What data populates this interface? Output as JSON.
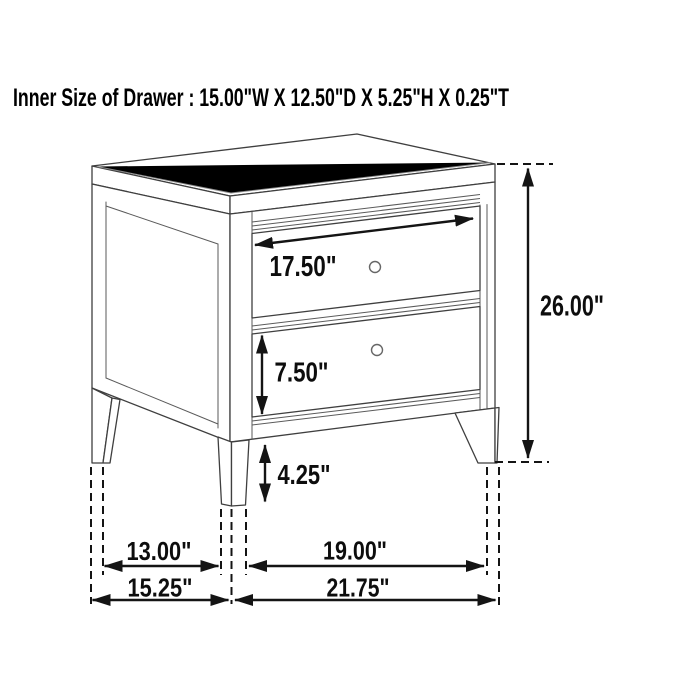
{
  "title": "Inner Size of Drawer : 15.00\"W X 12.50\"D X 5.25\"H X 0.25\"T",
  "dimension_labels": {
    "top_drawer_width": "17.50\"",
    "overall_height": "26.00\"",
    "bottom_drawer_height": "7.50\"",
    "leg_height": "4.25\"",
    "side_leg_inner_span": "13.00\"",
    "side_overall_depth": "15.25\"",
    "front_leg_inner_span": "19.00\"",
    "front_overall_width": "21.75\""
  },
  "colors": {
    "background": "#ffffff",
    "furniture_line": "#3f3f3f",
    "dimension_line": "#141414",
    "text": "#0d0d0d"
  }
}
